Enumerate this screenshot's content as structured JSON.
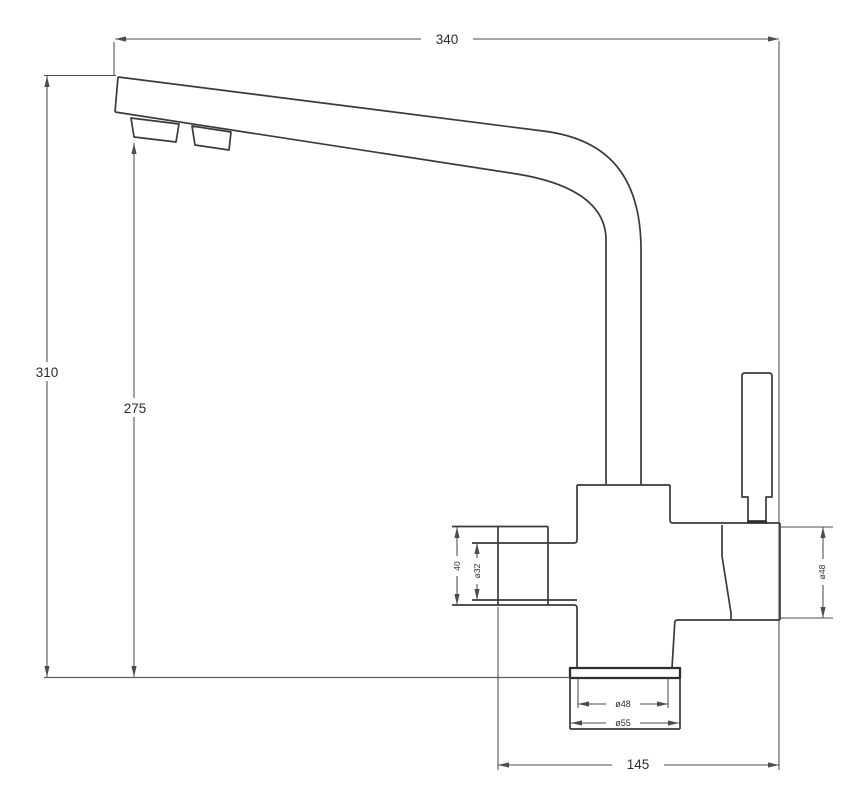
{
  "drawing": {
    "labels": {
      "overall_width": "340",
      "overall_height": "310",
      "spout_height": "275",
      "body_span": "145",
      "side_port_length": "40",
      "side_port_bore": "ø32",
      "valve_diameter": "ø48",
      "base_neck_diameter": "ø48",
      "base_flange_diameter": "ø55"
    }
  }
}
